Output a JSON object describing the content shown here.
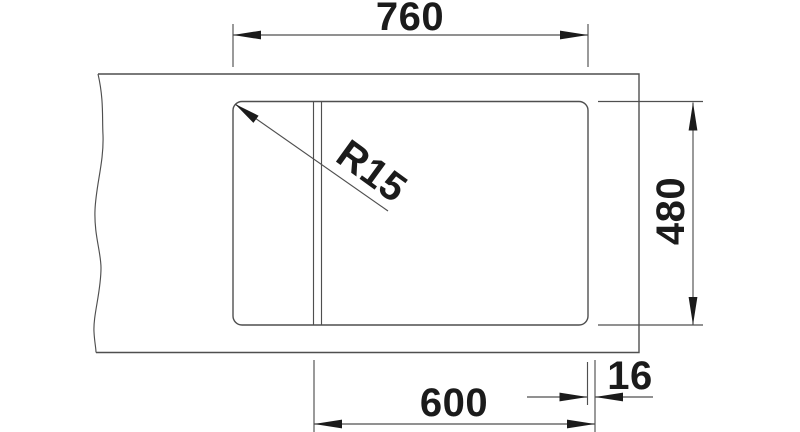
{
  "drawing": {
    "kind": "sink-installation-dimension-drawing",
    "labels": {
      "overall_width": "760",
      "depth": "480",
      "bowl_width": "600",
      "edge_offset": "16",
      "corner_radius": "R15"
    },
    "colors": {
      "background": "#ffffff",
      "line": "#4f4f4f",
      "ink": "#1b1b1b"
    }
  }
}
